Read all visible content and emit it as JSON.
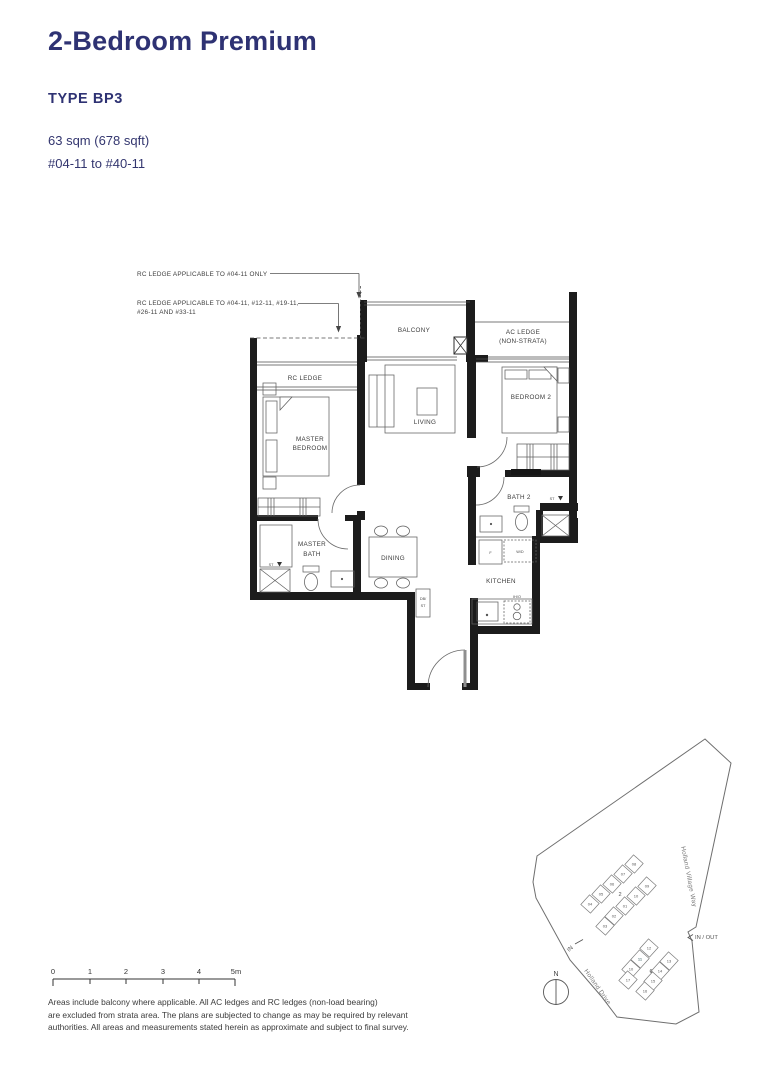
{
  "header": {
    "title": "2-Bedroom Premium",
    "unit_type": "TYPE BP3",
    "area": "63 sqm (678 sqft)",
    "stack_range": "#04-11 to #40-11"
  },
  "annotations": {
    "note1": "RC LEDGE APPLICABLE TO #04-11 ONLY",
    "note2_line1": "RC LEDGE APPLICABLE TO #04-11, #12-11, #19-11,",
    "note2_line2": "#26-11 AND #33-11"
  },
  "rooms": {
    "balcony": "BALCONY",
    "ac_ledge_1": "AC LEDGE",
    "ac_ledge_2": "(NON-STRATA)",
    "rc_ledge": "RC LEDGE",
    "master_1": "MASTER",
    "master_2": "BEDROOM",
    "living": "LIVING",
    "bedroom2": "BEDROOM 2",
    "bath2": "BATH 2",
    "master_bath_1": "MASTER",
    "master_bath_2": "BATH",
    "dining": "DINING",
    "kitchen": "KITCHEN"
  },
  "fixtures": {
    "fridge": "F",
    "washer_dryer": "W/D",
    "db_1": "DB/",
    "db_2": "ST",
    "hob": "IH/O",
    "shower_st_1": "ST",
    "shower_st_2": "ST"
  },
  "siteplan": {
    "road_1": "Holland Village Way",
    "road_2": "Holland Drive",
    "in_out": "IN / OUT",
    "in": "IN",
    "north": "N",
    "block_top": "2",
    "block_bottom": "6",
    "units_top": [
      "08",
      "07",
      "06",
      "05",
      "04",
      "09",
      "10",
      "01",
      "02",
      "03"
    ],
    "units_bottom": [
      "12",
      "11",
      "10",
      "13",
      "14",
      "15",
      "16",
      "17"
    ],
    "highlight": {
      "unit": "11",
      "color": "#5fc3c7"
    }
  },
  "scale_bar": {
    "labels": [
      "0",
      "1",
      "2",
      "3",
      "4",
      "5m"
    ]
  },
  "disclaimer": [
    "Areas include balcony where applicable. All AC ledges and RC ledges (non-load bearing)",
    "are excluded from strata area. The plans are subjected to change as may be required by relevant",
    "authorities. All areas and measurements stated herein as approximate and subject to final survey."
  ],
  "colors": {
    "heading": "#2e3273",
    "highlight_teal": "#5fc3c7"
  }
}
